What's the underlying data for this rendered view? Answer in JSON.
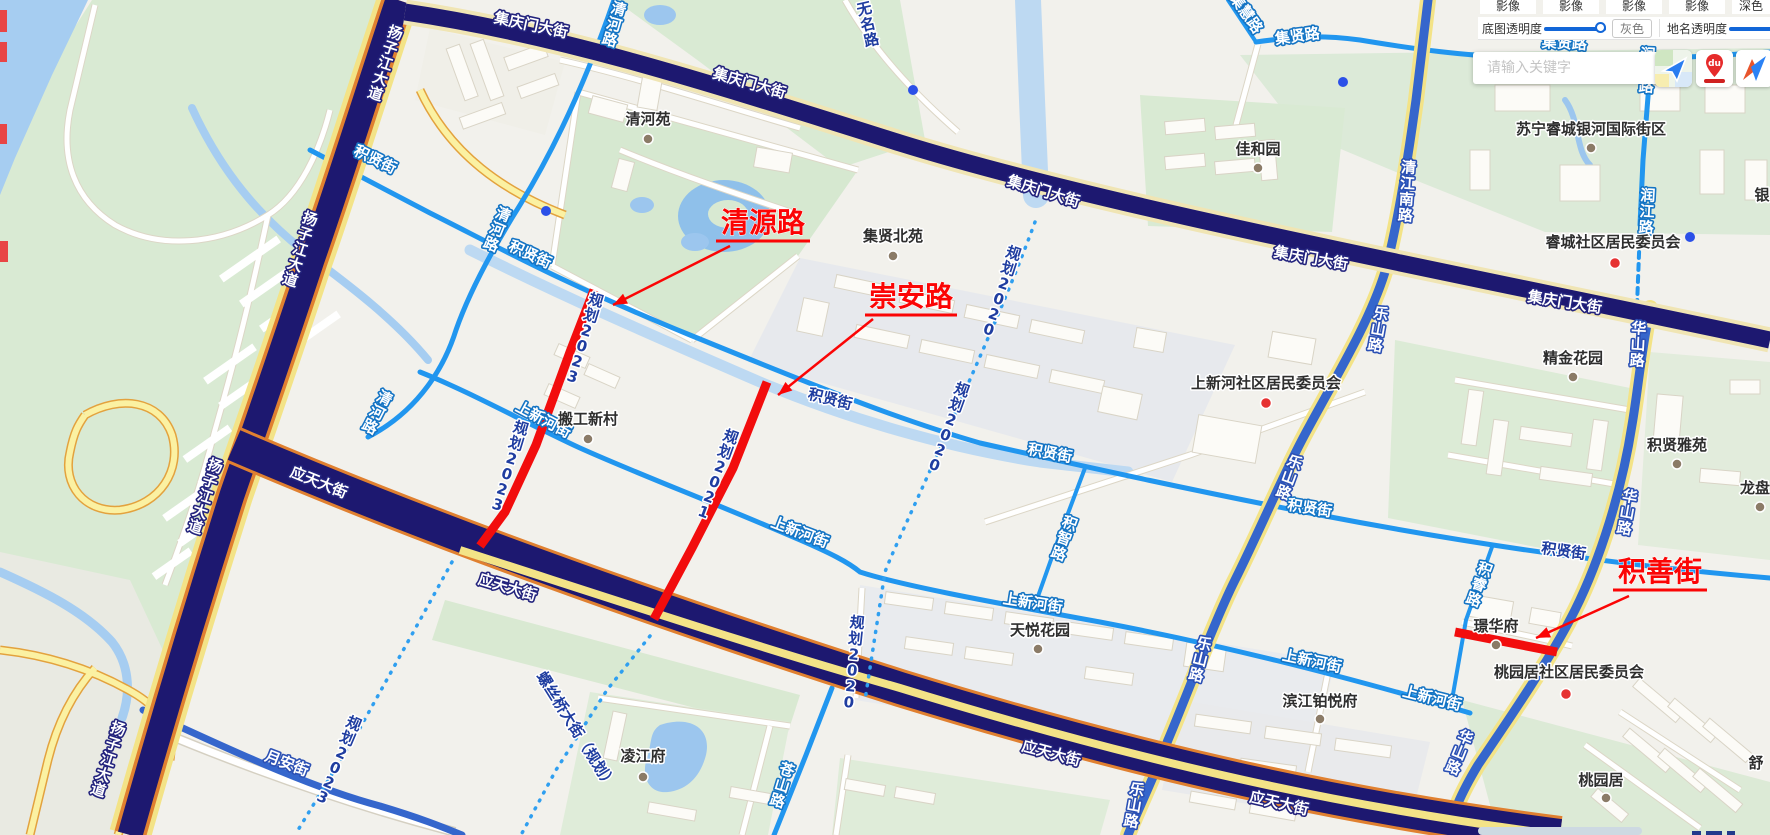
{
  "colors": {
    "annotation_red": "#fb0505",
    "highlight_red": "#f20d0d",
    "major_navy": "#1d1870",
    "arterial_blue": "#3566cc",
    "minor_azure": "#2196ef",
    "planned_dash": "#2f9ff0",
    "slider_blue": "#1266d8",
    "poi_brown": "#8b7b67",
    "poi_red": "#e63232",
    "poi_blue": "#2b50e8"
  },
  "panel": {
    "tabs": [
      "影像",
      "影像",
      "影像",
      "影像",
      "深色"
    ],
    "base_opacity_label": "底图透明度",
    "gray_button": "灰色",
    "name_opacity_label": "地名透明度"
  },
  "search": {
    "placeholder": "请输入关键字"
  },
  "app_icons": [
    {
      "name": "amap-icon"
    },
    {
      "name": "baidu-maps-icon",
      "badge": "du"
    },
    {
      "name": "tencent-maps-icon"
    }
  ],
  "map": {
    "road_labels": [
      {
        "t": "扬子江大道",
        "x": 385,
        "y": 64,
        "r": 18,
        "m": "v",
        "s": "navy"
      },
      {
        "t": "扬子江大道",
        "x": 300,
        "y": 250,
        "r": 18,
        "m": "v",
        "s": "navy"
      },
      {
        "t": "扬子江大道",
        "x": 205,
        "y": 497,
        "r": 18,
        "m": "v",
        "s": "navy"
      },
      {
        "t": "扬子江大道",
        "x": 108,
        "y": 760,
        "r": 18,
        "m": "v",
        "s": "navy"
      },
      {
        "t": "集庆门大街",
        "x": 530,
        "y": 30,
        "r": 12,
        "m": "h",
        "s": "navy"
      },
      {
        "t": "集庆门大街",
        "x": 748,
        "y": 88,
        "r": 16,
        "m": "h",
        "s": "navy"
      },
      {
        "t": "集庆门大街",
        "x": 1042,
        "y": 196,
        "r": 17,
        "m": "h",
        "s": "navy"
      },
      {
        "t": "集庆门大街",
        "x": 1310,
        "y": 263,
        "r": 10,
        "m": "h",
        "s": "navy"
      },
      {
        "t": "集庆门大街",
        "x": 1564,
        "y": 307,
        "r": 9,
        "m": "h",
        "s": "navy"
      },
      {
        "t": "应天大街",
        "x": 317,
        "y": 487,
        "r": 22,
        "m": "h",
        "s": "navy"
      },
      {
        "t": "应天大街",
        "x": 506,
        "y": 592,
        "r": 17,
        "m": "h",
        "s": "navy"
      },
      {
        "t": "应天大街",
        "x": 1050,
        "y": 758,
        "r": 15,
        "m": "h",
        "s": "navy"
      },
      {
        "t": "应天大街",
        "x": 1278,
        "y": 808,
        "r": 13,
        "m": "h",
        "s": "navy"
      },
      {
        "t": "乐山路",
        "x": 1378,
        "y": 330,
        "r": 10,
        "m": "v",
        "s": "mid"
      },
      {
        "t": "乐山路",
        "x": 1289,
        "y": 478,
        "r": 20,
        "m": "v",
        "s": "mid"
      },
      {
        "t": "乐山路",
        "x": 1200,
        "y": 660,
        "r": 14,
        "m": "v",
        "s": "mid"
      },
      {
        "t": "乐山路",
        "x": 1134,
        "y": 806,
        "r": 10,
        "m": "v",
        "s": "mid"
      },
      {
        "t": "清江南路",
        "x": 1407,
        "y": 192,
        "r": 4,
        "m": "v",
        "s": "mid"
      },
      {
        "t": "华山路",
        "x": 1638,
        "y": 345,
        "r": 3,
        "m": "v",
        "s": "mid"
      },
      {
        "t": "华山路",
        "x": 1627,
        "y": 513,
        "r": 10,
        "m": "v",
        "s": "mid"
      },
      {
        "t": "华山路",
        "x": 1459,
        "y": 753,
        "r": 22,
        "m": "v",
        "s": "mid"
      },
      {
        "t": "月安街",
        "x": 285,
        "y": 768,
        "r": 21,
        "m": "h",
        "s": "mid"
      },
      {
        "t": "积贤街",
        "x": 373,
        "y": 164,
        "r": 26,
        "m": "h",
        "s": "azure"
      },
      {
        "t": "积贤街",
        "x": 528,
        "y": 259,
        "r": 25,
        "m": "h",
        "s": "azure"
      },
      {
        "t": "积贤街",
        "x": 1049,
        "y": 458,
        "r": 11,
        "m": "h",
        "s": "azure"
      },
      {
        "t": "积贤街",
        "x": 1309,
        "y": 513,
        "r": 9,
        "m": "h",
        "s": "azure"
      },
      {
        "t": "积贤街",
        "x": 829,
        "y": 404,
        "r": 14,
        "m": "h",
        "s": "dark"
      },
      {
        "t": "积贤街",
        "x": 1563,
        "y": 556,
        "r": 8,
        "m": "h",
        "s": "dark"
      },
      {
        "t": "上新河街",
        "x": 541,
        "y": 424,
        "r": 28,
        "m": "h",
        "s": "azure"
      },
      {
        "t": "上新河街",
        "x": 798,
        "y": 537,
        "r": 21,
        "m": "h",
        "s": "azure"
      },
      {
        "t": "上新河街",
        "x": 1032,
        "y": 608,
        "r": 9,
        "m": "h",
        "s": "azure"
      },
      {
        "t": "上新河街",
        "x": 1311,
        "y": 666,
        "r": 12,
        "m": "h",
        "s": "azure"
      },
      {
        "t": "上新河街",
        "x": 1431,
        "y": 703,
        "r": 14,
        "m": "h",
        "s": "azure"
      },
      {
        "t": "集贤路",
        "x": 1298,
        "y": 41,
        "r": -8,
        "m": "h",
        "s": "azure"
      },
      {
        "t": "集贤路",
        "x": 1564,
        "y": 48,
        "r": 3,
        "m": "h",
        "s": "azure"
      },
      {
        "t": "集慧路",
        "x": 1242,
        "y": 16,
        "r": 55,
        "m": "h",
        "s": "azure"
      },
      {
        "t": "清河路",
        "x": 614,
        "y": 25,
        "r": 16,
        "m": "v",
        "s": "azure"
      },
      {
        "t": "清河路",
        "x": 497,
        "y": 230,
        "r": 22,
        "m": "v",
        "s": "azure"
      },
      {
        "t": "清河路",
        "x": 377,
        "y": 413,
        "r": 27,
        "m": "v",
        "s": "azure"
      },
      {
        "t": "苍山路",
        "x": 782,
        "y": 786,
        "r": 17,
        "m": "v",
        "s": "azure"
      },
      {
        "t": "积智路",
        "x": 1064,
        "y": 539,
        "r": 20,
        "m": "v",
        "s": "azure"
      },
      {
        "t": "积睿路",
        "x": 1479,
        "y": 585,
        "r": 20,
        "m": "v",
        "s": "azure"
      },
      {
        "t": "润江路",
        "x": 1647,
        "y": 71,
        "r": 3,
        "m": "v",
        "s": "azure"
      },
      {
        "t": "润江路",
        "x": 1647,
        "y": 212,
        "r": 3,
        "m": "v",
        "s": "azure"
      },
      {
        "t": "无名路",
        "x": 868,
        "y": 25,
        "r": -13,
        "m": "v",
        "s": "dark"
      },
      {
        "t": "规划2023",
        "x": 584,
        "y": 339,
        "r": 17,
        "m": "v",
        "s": "dark"
      },
      {
        "t": "规划2023",
        "x": 509,
        "y": 467,
        "r": 17,
        "m": "v",
        "s": "dark"
      },
      {
        "t": "规划2023",
        "x": 338,
        "y": 761,
        "r": 23,
        "m": "v",
        "s": "dark"
      },
      {
        "t": "规划2021",
        "x": 717,
        "y": 475,
        "r": 20,
        "m": "v",
        "s": "dark"
      },
      {
        "t": "规划2020",
        "x": 1001,
        "y": 292,
        "r": 18,
        "m": "v",
        "s": "dark"
      },
      {
        "t": "规划2020",
        "x": 948,
        "y": 428,
        "r": 20,
        "m": "v",
        "s": "dark"
      },
      {
        "t": "规划2020",
        "x": 853,
        "y": 663,
        "r": 6,
        "m": "v",
        "s": "dark"
      },
      {
        "t": "螺丝桥大街（规划）",
        "x": 572,
        "y": 733,
        "r": 58,
        "m": "h",
        "s": "dark"
      }
    ],
    "place_labels": [
      {
        "t": "清河苑",
        "x": 648,
        "y": 124,
        "dot": "brown",
        "dx": 0,
        "dy": 15
      },
      {
        "t": "搬工新村",
        "x": 588,
        "y": 424,
        "dot": "brown",
        "dx": 0,
        "dy": 15
      },
      {
        "t": "集贤北苑",
        "x": 893,
        "y": 241,
        "dot": "brown",
        "dx": 0,
        "dy": 15
      },
      {
        "t": "佳和园",
        "x": 1258,
        "y": 154,
        "dot": "brown",
        "dx": 0,
        "dy": 14
      },
      {
        "t": "天悦花园",
        "x": 1040,
        "y": 635,
        "dot": "brown",
        "dx": -2,
        "dy": 14
      },
      {
        "t": "凌江府",
        "x": 643,
        "y": 761,
        "dot": "brown",
        "dx": 0,
        "dy": 16
      },
      {
        "t": "璟华府",
        "x": 1496,
        "y": 631,
        "dot": "brown",
        "dx": 0,
        "dy": 14
      },
      {
        "t": "桃园居",
        "x": 1601,
        "y": 785,
        "dot": "brown",
        "dx": 5,
        "dy": 13
      },
      {
        "t": "滨江铂悦府",
        "x": 1320,
        "y": 706,
        "dot": "brown",
        "dx": 0,
        "dy": 13
      },
      {
        "t": "精金花园",
        "x": 1573,
        "y": 363,
        "dot": "brown",
        "dx": 0,
        "dy": 14
      },
      {
        "t": "积贤雅苑",
        "x": 1677,
        "y": 450,
        "dot": "brown",
        "dx": 0,
        "dy": 14
      },
      {
        "t": "苏宁睿城银河国际街区",
        "x": 1591,
        "y": 134,
        "dot": "brown",
        "dx": 0,
        "dy": 14
      },
      {
        "t": "上新河社区居民委员会",
        "x": 1266,
        "y": 388,
        "dot": "red",
        "dx": 0,
        "dy": 15
      },
      {
        "t": "睿城社区居民委员会",
        "x": 1613,
        "y": 247,
        "dot": "red",
        "dx": 2,
        "dy": 16
      },
      {
        "t": "桃园居社区居民委员会",
        "x": 1569,
        "y": 677,
        "dot": "red",
        "dx": -3,
        "dy": 17
      },
      {
        "t": "龙盘",
        "x": 1755,
        "y": 493,
        "dot": "brown",
        "dx": 5,
        "dy": 14
      },
      {
        "t": "银",
        "x": 1762,
        "y": 200,
        "dot": null,
        "dx": 0,
        "dy": 0
      },
      {
        "t": "舒",
        "x": 1756,
        "y": 768,
        "dot": null,
        "dx": 0,
        "dy": 0
      }
    ],
    "blue_dots": [
      [
        546,
        211
      ],
      [
        913,
        90
      ],
      [
        1343,
        82
      ],
      [
        1690,
        237
      ]
    ],
    "highlight_roads": [
      "M594,290 L570,352 L536,445 L505,512 L480,546",
      "M767,382 L733,468 L692,548 L654,619",
      "M1455,632 L1557,652"
    ],
    "annotations": [
      {
        "t": "清源路",
        "cx": 763,
        "by": 232,
        "underline": [
          716,
          810,
          241
        ],
        "leader": [
          730,
          246,
          613,
          305
        ]
      },
      {
        "t": "崇安路",
        "cx": 911,
        "by": 306,
        "underline": [
          865,
          957,
          315
        ],
        "leader": [
          873,
          319,
          778,
          395
        ]
      },
      {
        "t": "积善街",
        "cx": 1660,
        "by": 581,
        "underline": [
          1613,
          1707,
          590
        ],
        "leader": [
          1629,
          596,
          1536,
          638
        ]
      }
    ],
    "edge_marks": [
      [
        0,
        10,
        7,
        22
      ],
      [
        0,
        42,
        7,
        20
      ],
      [
        0,
        124,
        7,
        20
      ],
      [
        0,
        241,
        8,
        21
      ]
    ]
  }
}
